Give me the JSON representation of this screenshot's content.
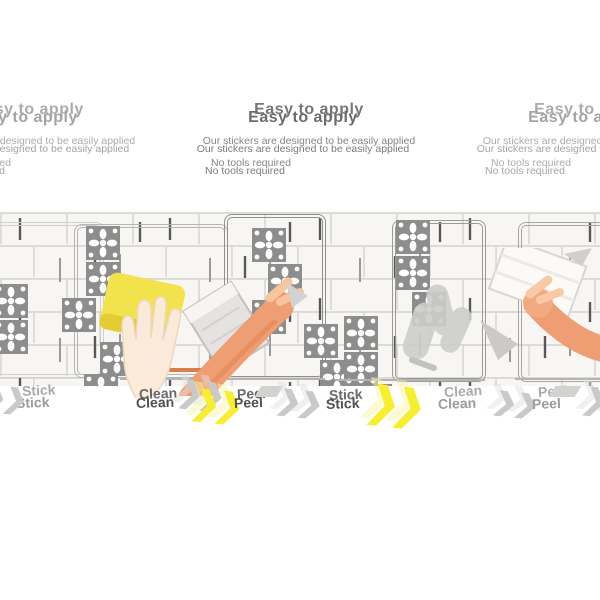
{
  "background": "#ffffff",
  "header": {
    "title": "Easy to apply",
    "subtitle_line1": "Our stickers are designed to be easily applied",
    "subtitle_line2": "No tools required"
  },
  "steps": {
    "labels": [
      "Clean",
      "Peel",
      "Stick"
    ],
    "ghost_labels": [
      "Stick",
      "Clean",
      "Peel"
    ]
  },
  "colors": {
    "title_text": "#6b6b6b",
    "subtitle_text": "#7b7b7b",
    "label_text": "#4f4f4f",
    "ghost_label_text": "#9b9b9b",
    "chevron_yellow": "#f7ee2e",
    "chevron_gray": "#c9c9c9",
    "sponge_yellow": "#f2e24b",
    "skin_light": "#f9ead9",
    "skin_orange": "#ef9e73",
    "tile_ornament_gray": "#8d8d8d",
    "tile_white": "#f7f6f3",
    "grout_light": "#dcdbd7",
    "grout_dark": "#585858"
  },
  "icons": {
    "chevron": "double-chevron-right-icon",
    "ornament": "moroccan-tile-ornament-icon"
  }
}
